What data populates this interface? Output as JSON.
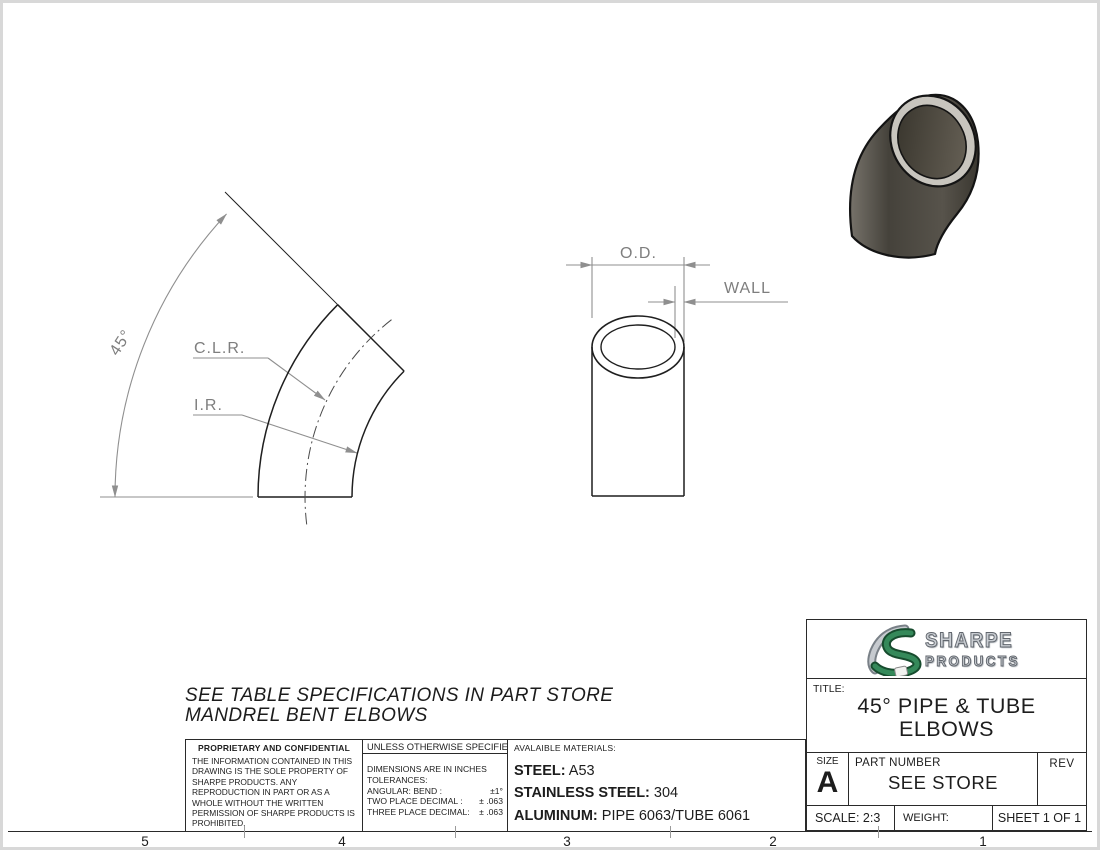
{
  "zones": {
    "labels": [
      "5",
      "4",
      "3",
      "2",
      "1"
    ]
  },
  "note": {
    "line1": "SEE TABLE SPECIFICATIONS IN PART STORE",
    "line2": "MANDREL BENT ELBOWS"
  },
  "drawing_labels": {
    "angle": "45°",
    "clr": "C.L.R.",
    "ir": "I.R.",
    "od": "O.D.",
    "wall": "WALL"
  },
  "proprietary": {
    "title": "PROPRIETARY AND CONFIDENTIAL",
    "body": "THE INFORMATION CONTAINED IN THIS DRAWING IS THE SOLE PROPERTY OF SHARPE PRODUCTS.  ANY REPRODUCTION IN PART OR AS A WHOLE WITHOUT THE WRITTEN PERMISSION OF SHARPE PRODUCTS IS PROHIBITED."
  },
  "tolerances": {
    "header": "UNLESS OTHERWISE SPECIFIED:",
    "line1": "DIMENSIONS ARE IN INCHES",
    "line2": "TOLERANCES:",
    "rows": [
      {
        "label": "ANGULAR: BEND :",
        "value": "±1°"
      },
      {
        "label": "TWO PLACE DECIMAL :",
        "value": "± .063"
      },
      {
        "label": "THREE PLACE DECIMAL:",
        "value": "± .063"
      }
    ]
  },
  "materials": {
    "header": "AVALAIBLE MATERIALS:",
    "rows": [
      {
        "label": "STEEL:",
        "value": "A53"
      },
      {
        "label": "STAINLESS STEEL:",
        "value": "304"
      },
      {
        "label": "ALUMINUM:",
        "value": "PIPE 6063/TUBE 6061"
      }
    ]
  },
  "title_block": {
    "logo_line1": "SHARPE",
    "logo_line2": "PRODUCTS",
    "title_label": "TITLE:",
    "title_line1": "45° PIPE & TUBE",
    "title_line2": "ELBOWS",
    "size_label": "SIZE",
    "size_value": "A",
    "part_label": "PART NUMBER",
    "part_value": "SEE STORE",
    "rev_label": "REV",
    "scale_text": "SCALE: 2:3",
    "weight_text": "WEIGHT:",
    "sheet_text": "SHEET 1 OF 1"
  },
  "colors": {
    "line_gray": "#8f8f8f",
    "line_black": "#1f1f1f",
    "logo_green": "#35895a",
    "logo_silver": "#c6cacf",
    "elbow_body_dark": "#45423b",
    "elbow_body_light": "#746f66",
    "elbow_rim": "#c8c5be"
  }
}
